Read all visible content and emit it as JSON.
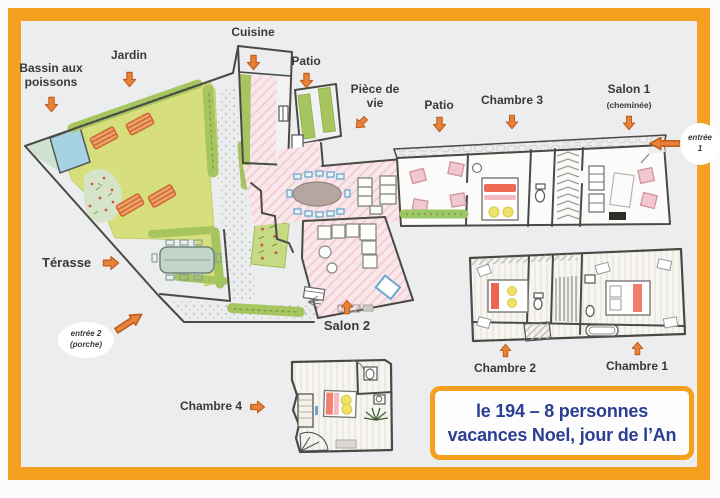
{
  "labels": {
    "bassin": "Bassin aux poissons",
    "jardin": "Jardin",
    "cuisine": "Cuisine",
    "patio_a": "Patio",
    "piece_de_vie": "Pièce de vie",
    "patio_b": "Patio",
    "chambre3": "Chambre 3",
    "salon1": "Salon 1",
    "salon1_note": "(cheminée)",
    "terasse": "Térasse",
    "salon2": "Salon 2",
    "chambre4": "Chambre 4",
    "chambre2": "Chambre 2",
    "chambre1": "Chambre 1",
    "entree1_line1": "entrée",
    "entree1_line2": "1",
    "entree2_line1": "entrée 2",
    "entree2_line2": "(porche)"
  },
  "info_box": {
    "line1": "le 194 – 8 personnes",
    "line2": "vacances Noel, jour de l’An"
  },
  "colors": {
    "frame_orange": "#F5A01E",
    "arrow_fill": "#E8823B",
    "arrow_outline": "#C2601F",
    "info_text_blue": "#2B3F92",
    "label_text": "#3A3A38",
    "lawn_green": "#D6DF7C",
    "hedge_green": "#A6C560",
    "pond_blue": "#A7D2E4",
    "floor_pink": "#F9E7EA",
    "bed_red": "#ED6A55",
    "pillow_yellow": "#EFE26A",
    "wall_gray": "#4A4A45",
    "paper": "#ECEDEF"
  }
}
